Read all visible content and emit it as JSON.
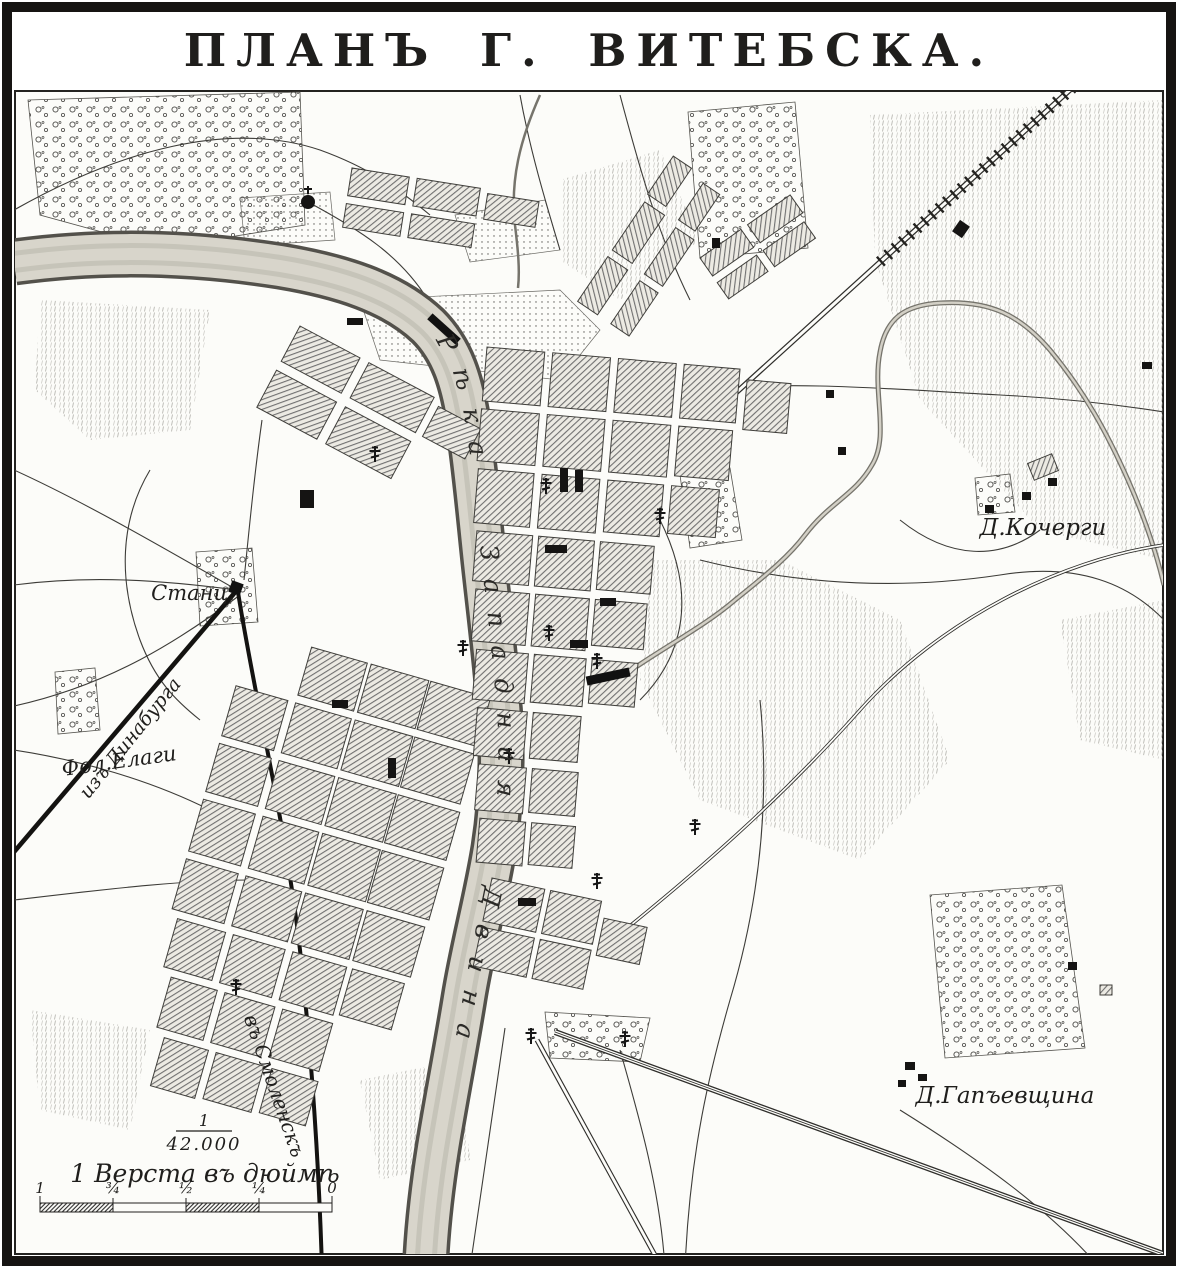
{
  "header": {
    "title": "ПЛАНЪ Г. ВИТЕБСКА."
  },
  "labels": {
    "river": "Рѣка Западная Двина",
    "station": "Станц.",
    "fol_elagi": "Фол.Елаги",
    "iz_dinaburga": "изъ Динабурга",
    "v_smolensk": "въ Смоленскъ",
    "d_kochergi": "Д.Кочерги",
    "d_gapyevshchina": "Д.Гапъевщина"
  },
  "scale": {
    "fraction_numerator": "1",
    "fraction_denominator": "42.000",
    "caption": "1 Верста въ дюймѣ",
    "bar_ticks": [
      "1",
      "¾",
      "½",
      "¼",
      "0"
    ]
  },
  "colors": {
    "ink": "#1f1e1c",
    "paper": "#fcfcf9",
    "river_fill": "#d8d5cb",
    "block_hatch": "#6f6f6f"
  }
}
